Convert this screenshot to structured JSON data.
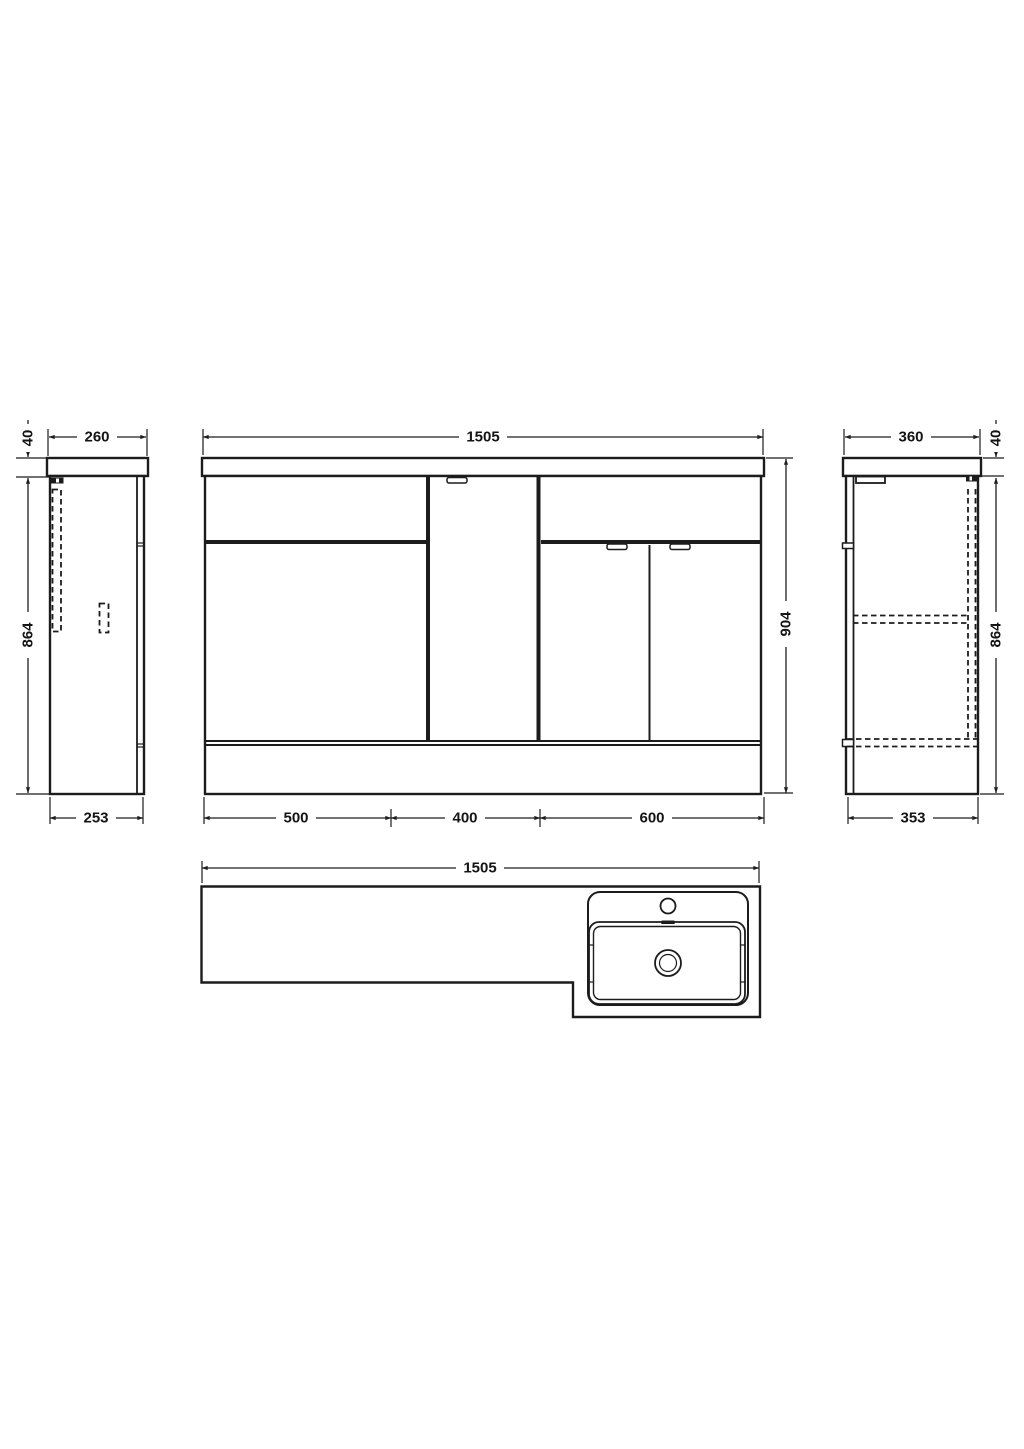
{
  "drawing": {
    "title": "bathroom-furniture-run-technical-drawing",
    "background": "#ffffff",
    "line_color": "#1c1c1c",
    "labels": {
      "left_view": {
        "worktop_thickness": "40",
        "top_width": "260",
        "height": "864",
        "bottom_depth": "253"
      },
      "front_view": {
        "total_width": "1505",
        "total_height": "904",
        "section_widths": [
          "500",
          "400",
          "600"
        ]
      },
      "right_view": {
        "worktop_thickness": "40",
        "top_width": "360",
        "height": "864",
        "bottom_depth": "353"
      },
      "plan_view": {
        "total_width": "1505"
      }
    }
  }
}
